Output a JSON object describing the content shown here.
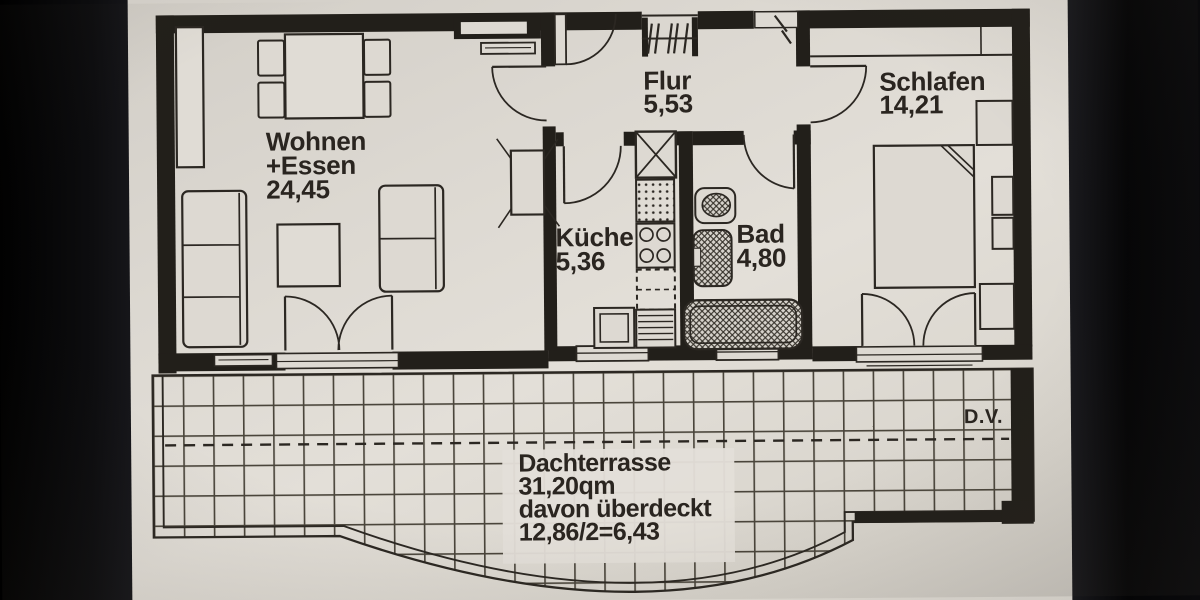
{
  "rooms": {
    "wohnen": {
      "name": "Wohnen",
      "name2": "+Essen",
      "area": "24,45"
    },
    "flur": {
      "name": "Flur",
      "area": "5,53"
    },
    "schlafen": {
      "name": "Schlafen",
      "area": "14,21"
    },
    "kueche": {
      "name": "Küche",
      "area": "5,36"
    },
    "bad": {
      "name": "Bad",
      "area": "4,80"
    }
  },
  "terrace": {
    "name": "Dachterrasse",
    "area": "31,20qm",
    "covered_label": "davon überdeckt",
    "covered_value": "12,86/2=6,43",
    "roof_edge_marker": "D.V."
  },
  "colors": {
    "paper": "#dedad3",
    "ink": "#2b2722",
    "wall": "#221f1a",
    "background": "#060607"
  }
}
